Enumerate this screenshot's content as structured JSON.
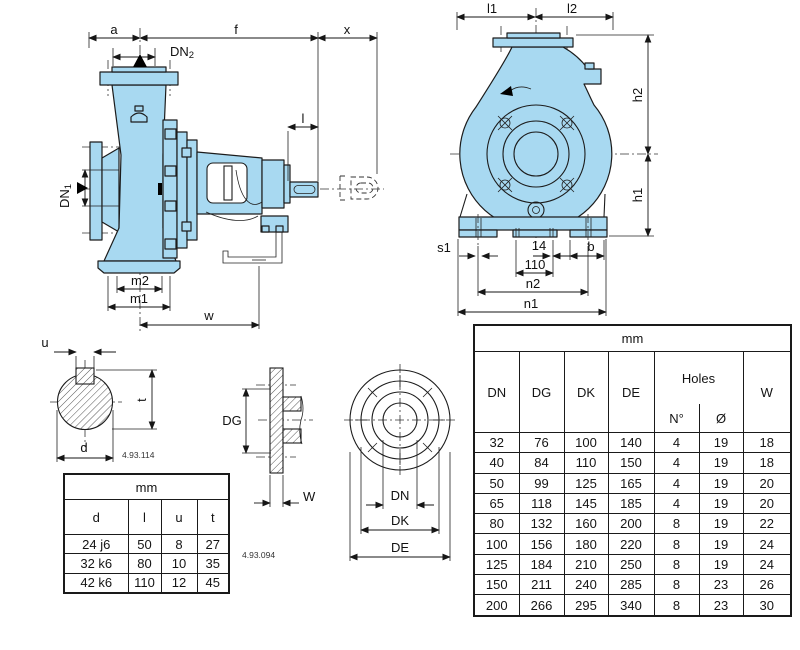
{
  "side_view": {
    "dims": {
      "a": "a",
      "f": "f",
      "x": "x",
      "l": "l",
      "m2": "m2",
      "m1": "m1",
      "w": "w"
    },
    "dn2": {
      "base": "DN",
      "sub": "2"
    },
    "dn1": {
      "base": "DN",
      "sub": "1"
    }
  },
  "end_view": {
    "dims": {
      "l1": "l1",
      "l2": "l2",
      "h2": "h2",
      "h1": "h1",
      "s1": "s1",
      "slot_width": "14",
      "slot_pitch": "110",
      "b": "b",
      "n2": "n2",
      "n1": "n1"
    }
  },
  "shaft_detail": {
    "dims": {
      "u": "u",
      "t": "t",
      "d": "d"
    },
    "ref": "4.93.114"
  },
  "shaft_table": {
    "unit": "mm",
    "headers": [
      "d",
      "l",
      "u",
      "t"
    ],
    "rows": [
      [
        "24 j6",
        "50",
        "8",
        "27"
      ],
      [
        "32 k6",
        "80",
        "10",
        "35"
      ],
      [
        "42 k6",
        "110",
        "12",
        "45"
      ]
    ]
  },
  "flange_profile": {
    "dims": {
      "dg": "DG",
      "w": "W"
    },
    "ref": "4.93.094"
  },
  "flange_front": {
    "dims": {
      "dn": "DN",
      "dk": "DK",
      "de": "DE"
    }
  },
  "dims_table": {
    "unit": "mm",
    "headers": {
      "dn": "DN",
      "dg": "DG",
      "dk": "DK",
      "de": "DE",
      "holes": "Holes",
      "n": "N°",
      "dia": "Ø",
      "w": "W"
    },
    "rows": [
      [
        "32",
        "76",
        "100",
        "140",
        "4",
        "19",
        "18"
      ],
      [
        "40",
        "84",
        "110",
        "150",
        "4",
        "19",
        "18"
      ],
      [
        "50",
        "99",
        "125",
        "165",
        "4",
        "19",
        "20"
      ],
      [
        "65",
        "118",
        "145",
        "185",
        "4",
        "19",
        "20"
      ],
      [
        "80",
        "132",
        "160",
        "200",
        "8",
        "19",
        "22"
      ],
      [
        "100",
        "156",
        "180",
        "220",
        "8",
        "19",
        "24"
      ],
      [
        "125",
        "184",
        "210",
        "250",
        "8",
        "19",
        "24"
      ],
      [
        "150",
        "211",
        "240",
        "285",
        "8",
        "23",
        "26"
      ],
      [
        "200",
        "266",
        "295",
        "340",
        "8",
        "23",
        "30"
      ]
    ]
  }
}
